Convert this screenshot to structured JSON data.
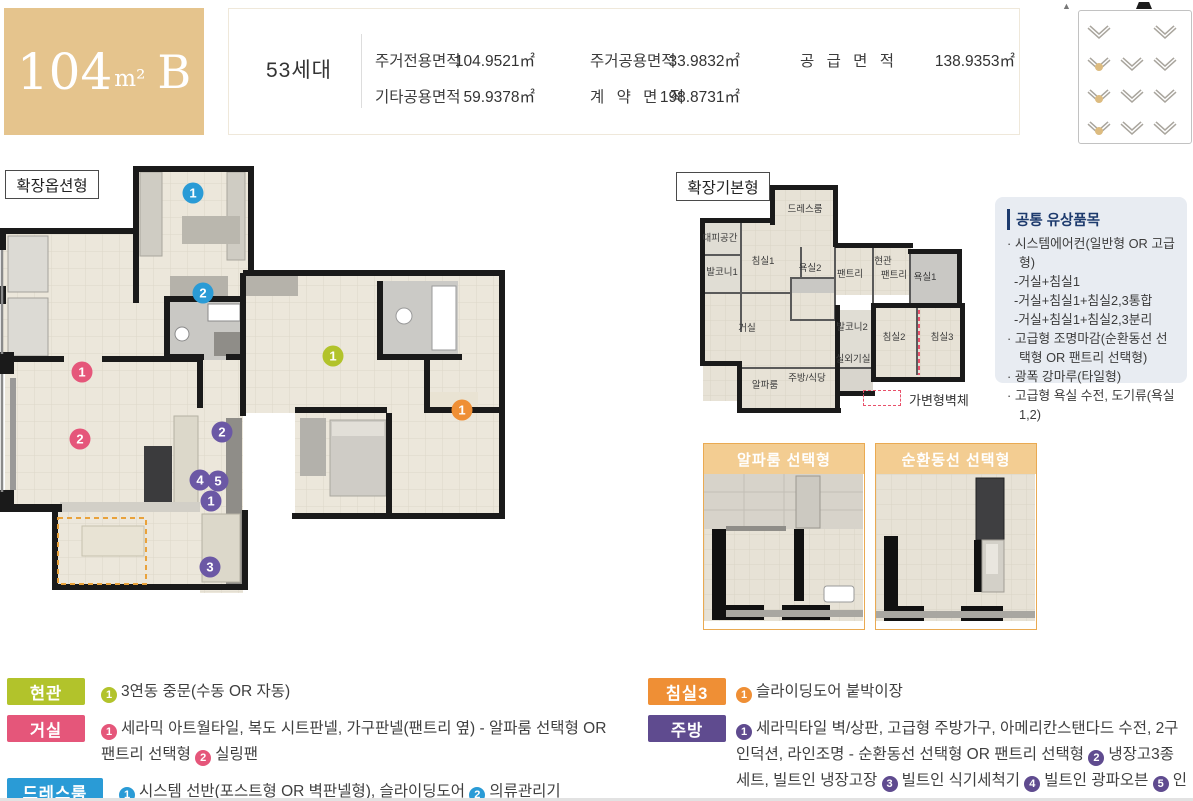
{
  "header": {
    "unit_size": "104",
    "unit_sup": "m²",
    "unit_type": "B",
    "households": "53세대",
    "areas": [
      {
        "label": "주거전용면적",
        "value": "104.9521㎡"
      },
      {
        "label": "주거공용면적",
        "value": "33.9832㎡"
      },
      {
        "label": "공 급 면 적",
        "value": "138.9353㎡"
      },
      {
        "label": "기타공용면적",
        "value": "59.9378㎡"
      },
      {
        "label": "계 약 면 적",
        "value": "198.8731㎡"
      }
    ]
  },
  "plans": {
    "option": {
      "title": "확장옵션형",
      "badges": [
        {
          "n": "1",
          "c": "blue",
          "x": 193,
          "y": 27
        },
        {
          "n": "2",
          "c": "blue",
          "x": 203,
          "y": 127
        },
        {
          "n": "1",
          "c": "pink",
          "x": 82,
          "y": 206
        },
        {
          "n": "2",
          "c": "pink",
          "x": 80,
          "y": 273
        },
        {
          "n": "1",
          "c": "green",
          "x": 333,
          "y": 190
        },
        {
          "n": "1",
          "c": "orange",
          "x": 462,
          "y": 244
        },
        {
          "n": "2",
          "c": "purple",
          "x": 222,
          "y": 266
        },
        {
          "n": "4",
          "c": "purple",
          "x": 200,
          "y": 314
        },
        {
          "n": "5",
          "c": "purple",
          "x": 218,
          "y": 315
        },
        {
          "n": "1",
          "c": "purple",
          "x": 211,
          "y": 335
        },
        {
          "n": "3",
          "c": "purple",
          "x": 210,
          "y": 401
        }
      ]
    },
    "basic": {
      "title": "확장기본형",
      "rooms": [
        {
          "t": "드레스룸",
          "x": 110,
          "y": 27
        },
        {
          "t": "대피공간",
          "x": 25,
          "y": 56
        },
        {
          "t": "침실1",
          "x": 68,
          "y": 79
        },
        {
          "t": "발코니1",
          "x": 27,
          "y": 90
        },
        {
          "t": "욕실2",
          "x": 115,
          "y": 86
        },
        {
          "t": "팬트리",
          "x": 155,
          "y": 92
        },
        {
          "t": "현관",
          "x": 188,
          "y": 79
        },
        {
          "t": "팬트리",
          "x": 199,
          "y": 93
        },
        {
          "t": "욕실1",
          "x": 230,
          "y": 95
        },
        {
          "t": "거실",
          "x": 52,
          "y": 146
        },
        {
          "t": "발코니2",
          "x": 157,
          "y": 145
        },
        {
          "t": "침실2",
          "x": 199,
          "y": 155
        },
        {
          "t": "침실3",
          "x": 247,
          "y": 155
        },
        {
          "t": "실외기실",
          "x": 158,
          "y": 177
        },
        {
          "t": "알파룸",
          "x": 70,
          "y": 203
        },
        {
          "t": "주방/식당",
          "x": 112,
          "y": 196
        }
      ],
      "variable_wall_label": "가변형벽체"
    }
  },
  "badge_colors": {
    "blue": "#2a9bd6",
    "pink": "#e5567a",
    "green": "#b2c32b",
    "orange": "#ef8f35",
    "purple": "#6b58a5"
  },
  "key_plan": {
    "grid": [
      [
        1,
        0,
        1
      ],
      [
        1,
        1,
        1
      ],
      [
        1,
        1,
        1
      ],
      [
        1,
        1,
        1
      ]
    ],
    "highlights": [
      {
        "r": 1,
        "c": 0
      },
      {
        "r": 2,
        "c": 0
      },
      {
        "r": 3,
        "c": 0
      }
    ],
    "highlight_color": "#dcbb80"
  },
  "paid_items": {
    "title": "공통 유상품목",
    "lines": [
      {
        "b": true,
        "t": "시스템에어컨(일반형 OR 고급형)"
      },
      {
        "b": false,
        "t": "-거실+침실1"
      },
      {
        "b": false,
        "t": "-거실+침실1+침실2,3통합"
      },
      {
        "b": false,
        "t": "-거실+침실1+침실2,3분리"
      },
      {
        "b": true,
        "t": "고급형 조명마감(순환동선 선택형 OR 팬트리 선택형)"
      },
      {
        "b": true,
        "t": "광폭 강마루(타일형)"
      },
      {
        "b": true,
        "t": "고급형 욕실 수전, 도기류(욕실1,2)"
      }
    ]
  },
  "option_cards": [
    {
      "title": "알파룸 선택형"
    },
    {
      "title": "순환동선 선택형"
    }
  ],
  "legend": {
    "left": [
      {
        "label": "현관",
        "color": "#b2c32b",
        "wide": false,
        "segments": [
          {
            "n": "1"
          },
          {
            "t": "3연동 중문(수동 OR 자동)"
          }
        ]
      },
      {
        "label": "거실",
        "color": "#e5567a",
        "wide": false,
        "segments": [
          {
            "n": "1"
          },
          {
            "t": "세라믹 아트월타일, 복도 시트판넬, 가구판넬(팬트리 옆) - 알파룸 선택형 OR 팬트리 선택형 "
          },
          {
            "n": "2"
          },
          {
            "t": "실링팬"
          }
        ]
      },
      {
        "label": "드레스룸",
        "color": "#2a9bd6",
        "wide": true,
        "segments": [
          {
            "n": "1"
          },
          {
            "t": "시스템 선반(포스트형 OR 벽판넬형), 슬라이딩도어 "
          },
          {
            "n": "2"
          },
          {
            "t": "의류관리기"
          }
        ]
      }
    ],
    "right": [
      {
        "label": "침실3",
        "color": "#ef8f35",
        "wide": false,
        "segments": [
          {
            "n": "1"
          },
          {
            "t": "슬라이딩도어 붙박이장"
          }
        ]
      },
      {
        "label": "주방",
        "color": "#5f4b8f",
        "wide": false,
        "segments": [
          {
            "n": "1"
          },
          {
            "t": "세라믹타일 벽/상판, 고급형 주방가구, 아메리칸스탠다드 수전, 2구 인덕션, 라인조명 - 순환동선 선택형 OR 팬트리 선택형 "
          },
          {
            "n": "2"
          },
          {
            "t": "냉장고3종 세트, 빌트인 냉장고장 "
          },
          {
            "n": "3"
          },
          {
            "t": "빌트인 식기세척기 "
          },
          {
            "n": "4"
          },
          {
            "t": "빌트인 광파오븐 "
          },
          {
            "n": "5"
          },
          {
            "t": "인덕션3구"
          }
        ]
      }
    ]
  }
}
